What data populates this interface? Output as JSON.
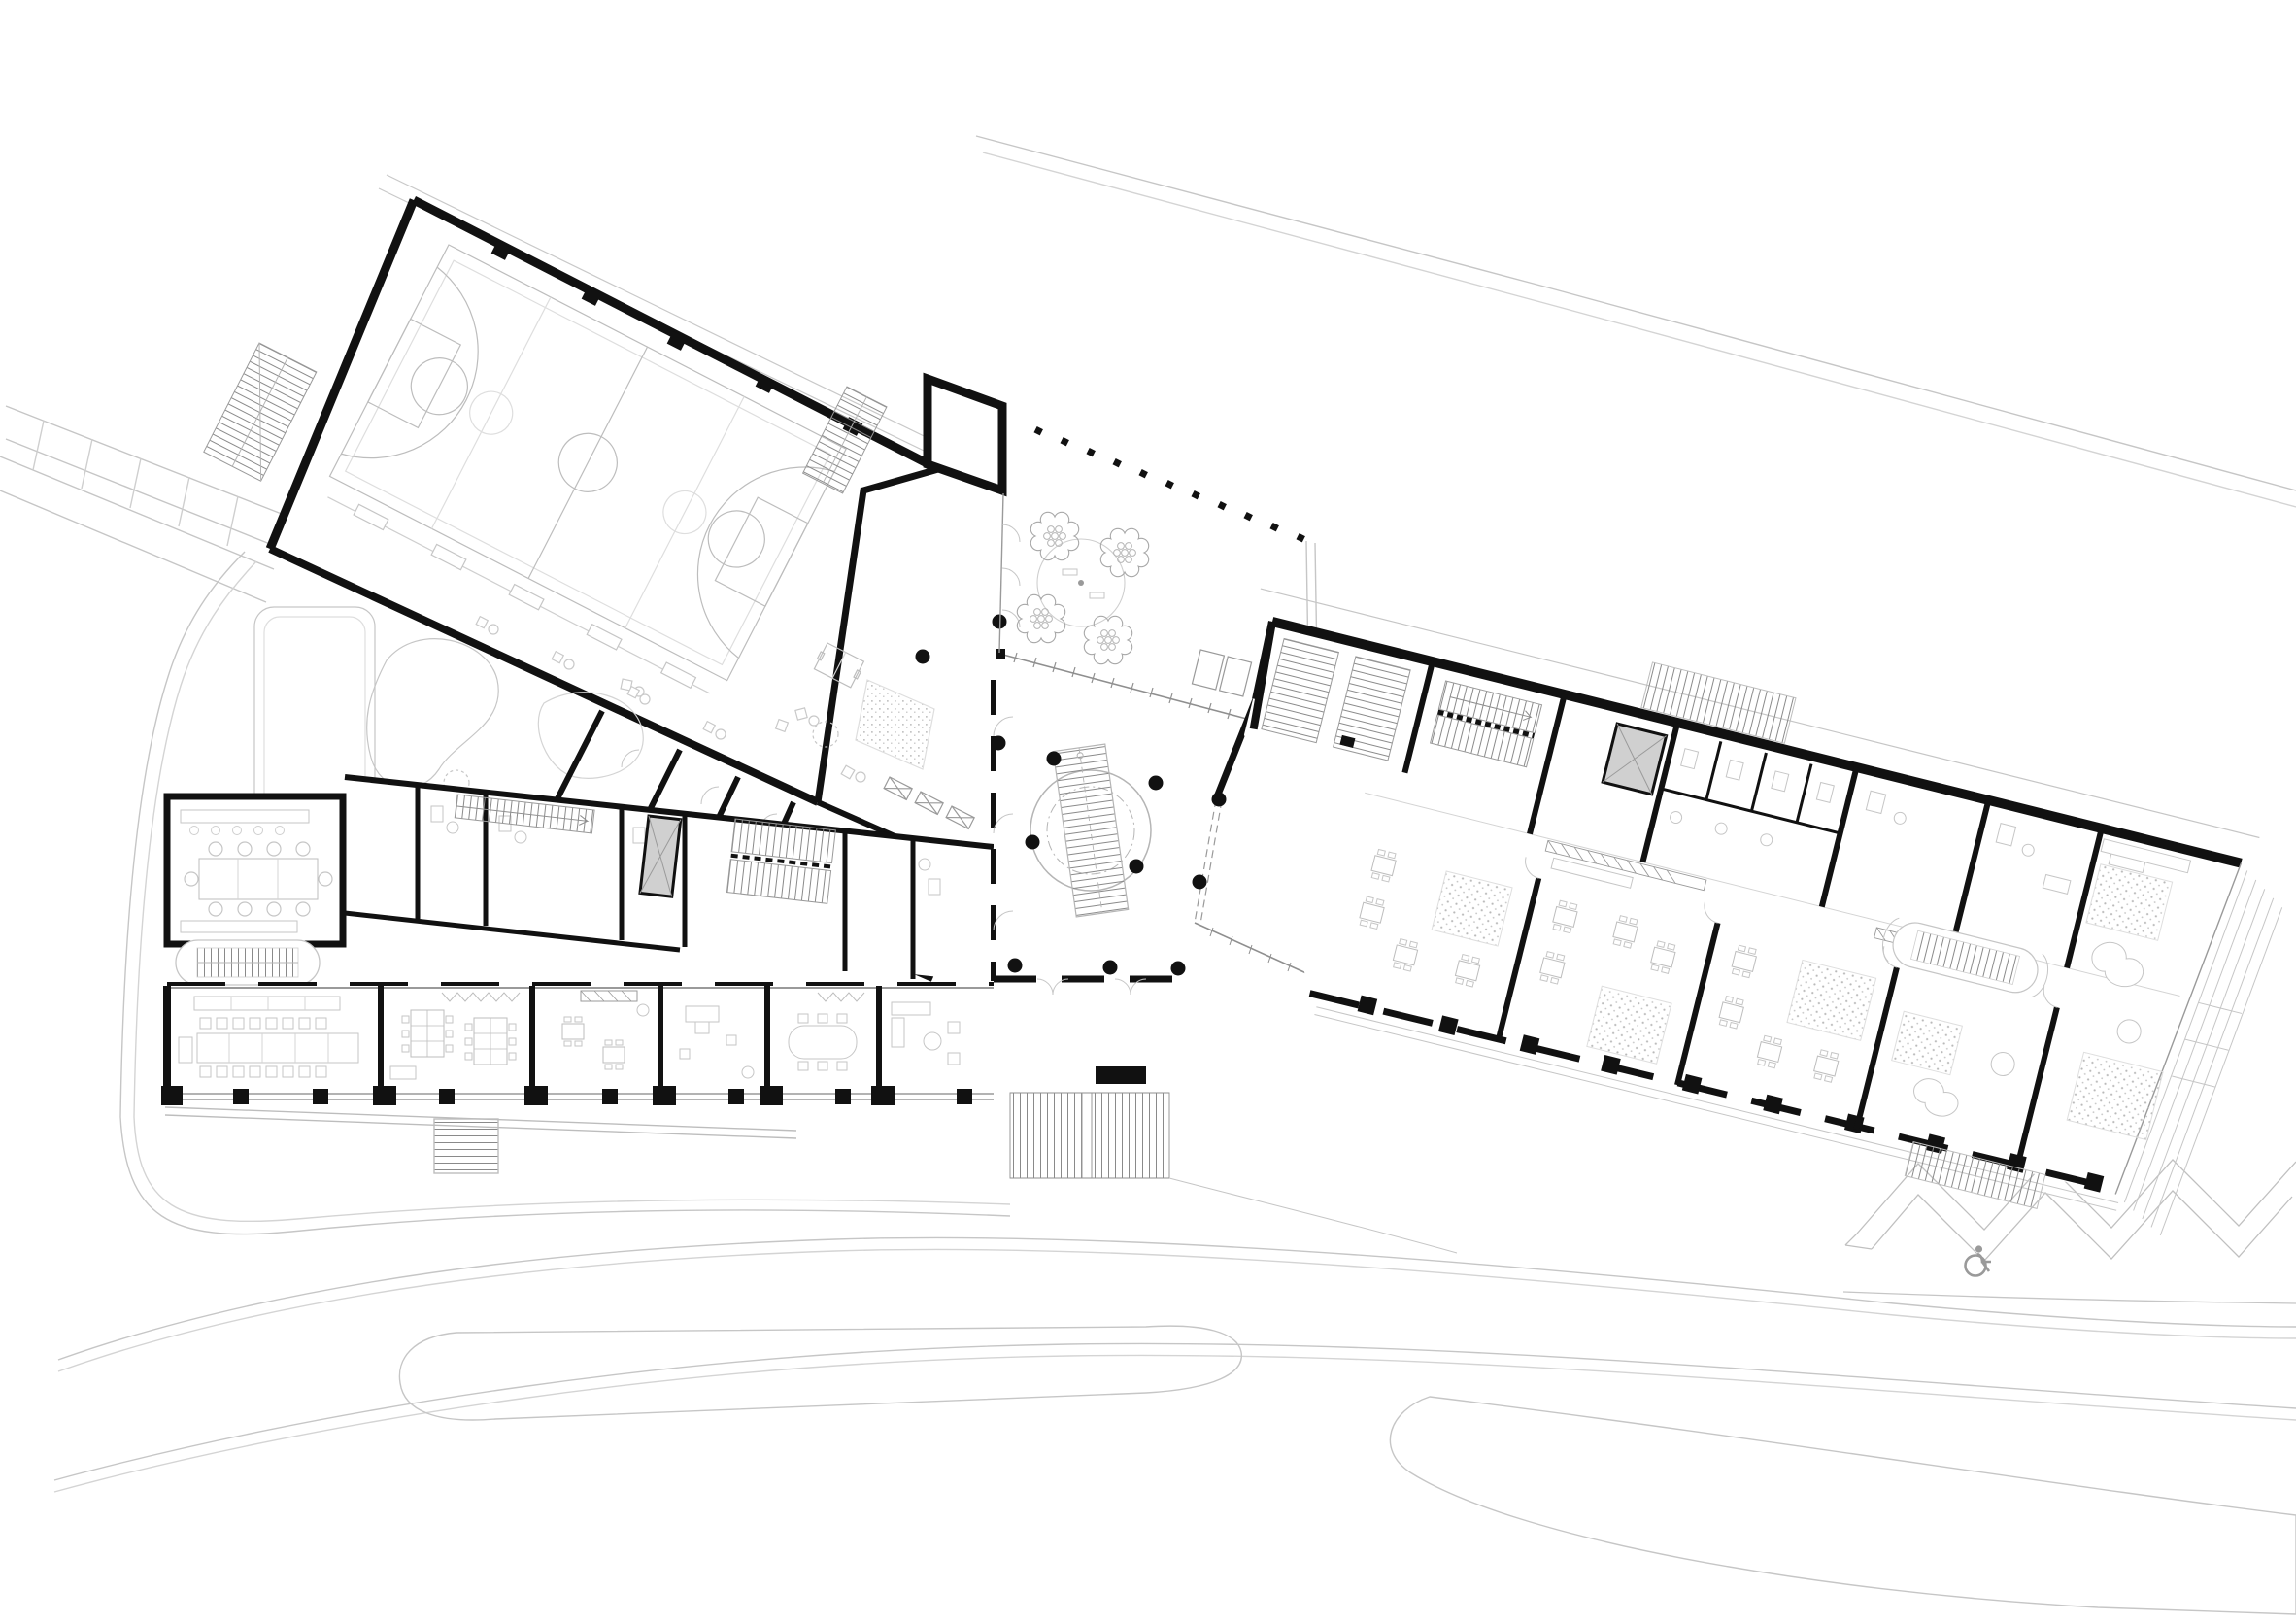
{
  "document": {
    "kind": "architectural-floor-plan",
    "view": "ground-floor site plan",
    "visible_text": []
  },
  "icons": {
    "wheelchair": {
      "name": "wheelchair-access-icon",
      "meaning": "accessible parking spot"
    }
  },
  "colors": {
    "background": "#ffffff",
    "wall": "#111111",
    "furniture": "#c2c2c2",
    "furniture_dark": "#9a9a9a",
    "site": "#c6c6c6",
    "court_lines": "#bdbdbd",
    "glass": "#8f8f8f",
    "elevator_fill": "#d0d0d0",
    "carpet_dot": "#b9b9b9",
    "icon": "#9a9a9a"
  },
  "zones": [
    {
      "id": "sports-hall",
      "label": "sports hall with basketball courts"
    },
    {
      "id": "courtyard",
      "label": "entrance courtyard with trees"
    },
    {
      "id": "atrium",
      "label": "central hall with circular stair"
    },
    {
      "id": "left-wing",
      "label": "south-west classroom wing"
    },
    {
      "id": "right-wing",
      "label": "east classroom wing"
    },
    {
      "id": "playground",
      "label": "play areas south of hall"
    },
    {
      "id": "parking",
      "label": "angled parking row with accessible spot"
    },
    {
      "id": "roads",
      "label": "site roads and paths"
    }
  ]
}
